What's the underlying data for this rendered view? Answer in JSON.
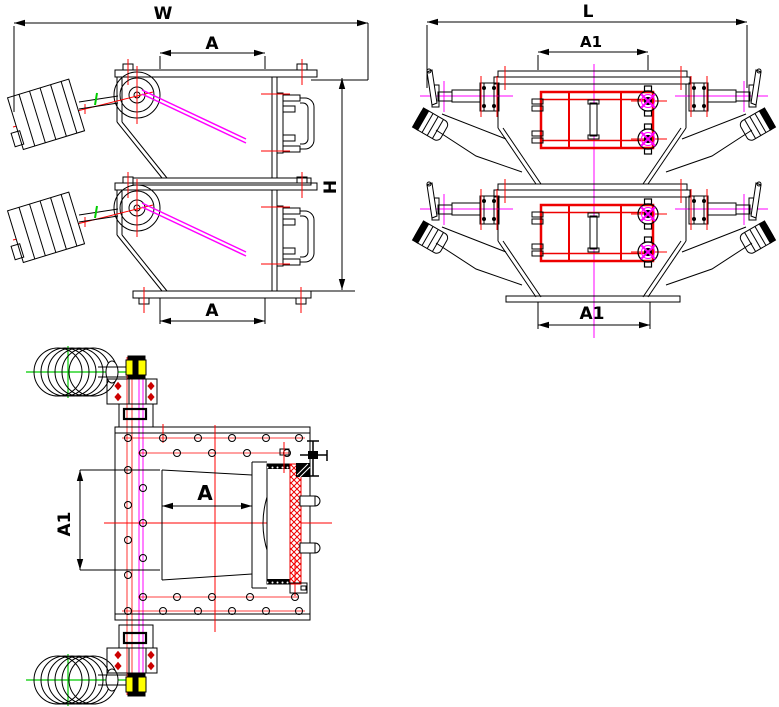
{
  "drawing": {
    "background": "#ffffff",
    "line_color": "#000000",
    "centerline_red": "#ff0000",
    "highlight_magenta": "#ff00ff",
    "shaft_green": "#00cc00",
    "coupling_yellow": "#ffff00",
    "door_frame_red": "#ee0000"
  },
  "front_view": {
    "width_label": "W",
    "inlet_label_top": "A",
    "height_label": "H",
    "inlet_label_bottom": "A"
  },
  "side_view": {
    "length_label": "L",
    "opening_label_top": "A1",
    "opening_label_bottom": "A1"
  },
  "plan_view": {
    "inlet_label": "A",
    "side_label": "A1"
  }
}
